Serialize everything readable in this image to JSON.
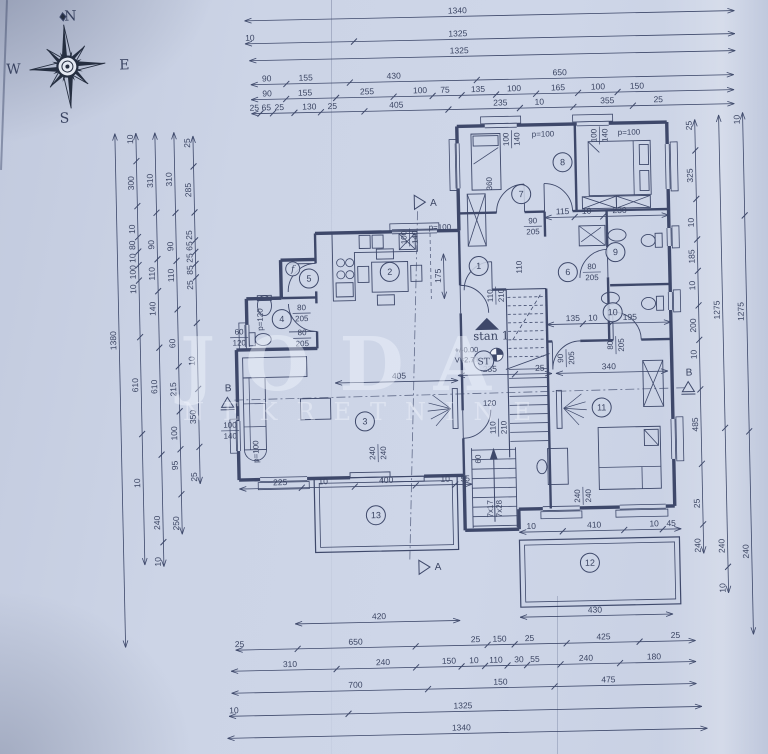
{
  "title": "apartment-floor-plan-scan",
  "colors": {
    "paper": "#ccd4e6",
    "ink": "#323d60",
    "ink_soft": "#46517a",
    "watermark": "rgba(244,248,255,0.42)"
  },
  "compass": {
    "north": "N",
    "east": "E",
    "south": "S",
    "west": "W"
  },
  "watermark": {
    "line1": "JODA",
    "line2": "NEKRETNINE"
  },
  "apartment_label": "stan 1",
  "stair_core_label": "ST",
  "level_marker": {
    "line1": "+/-0.00",
    "line2": "V=2.79"
  },
  "rooms": [
    {
      "n": "1",
      "x": 481,
      "y": 268
    },
    {
      "n": "2",
      "x": 392,
      "y": 272
    },
    {
      "n": "3",
      "x": 364,
      "y": 421
    },
    {
      "n": "4",
      "x": 283,
      "y": 317
    },
    {
      "n": "5",
      "x": 311,
      "y": 277
    },
    {
      "n": "6",
      "x": 570,
      "y": 276
    },
    {
      "n": "7",
      "x": 525,
      "y": 197
    },
    {
      "n": "8",
      "x": 567,
      "y": 166
    },
    {
      "n": "9",
      "x": 618,
      "y": 257
    },
    {
      "n": "10",
      "x": 614,
      "y": 317
    },
    {
      "n": "11",
      "x": 601,
      "y": 412
    },
    {
      "n": "12",
      "x": 586,
      "y": 567
    },
    {
      "n": "13",
      "x": 373,
      "y": 515
    }
  ],
  "small_circles": [
    {
      "n": "f",
      "x": 295,
      "y": 267,
      "italic": true
    }
  ],
  "section_markers": [
    {
      "t": "A",
      "x": 437,
      "y": 207
    },
    {
      "t": "A",
      "x": 434,
      "y": 571
    },
    {
      "t": "B",
      "x": 228,
      "y": 388
    },
    {
      "t": "B",
      "x": 689,
      "y": 382
    }
  ],
  "plan_labels": [
    {
      "t": "100/140",
      "x": 516,
      "y": 142,
      "rot": 90,
      "fr": true
    },
    {
      "t": "p=100",
      "x": 548,
      "y": 140
    },
    {
      "t": "100/140",
      "x": 604,
      "y": 140,
      "rot": 90,
      "fr": true
    },
    {
      "t": "p=100",
      "x": 634,
      "y": 140
    },
    {
      "t": "360",
      "x": 496,
      "y": 186,
      "rot": 90
    },
    {
      "t": "90/205",
      "x": 536,
      "y": 229,
      "fr": true
    },
    {
      "t": "80/205",
      "x": 594,
      "y": 276,
      "fr": true
    },
    {
      "t": "80/205",
      "x": 616,
      "y": 350,
      "rot": 90,
      "fr": true
    },
    {
      "t": "90/205",
      "x": 566,
      "y": 362,
      "rot": 90,
      "fr": true
    },
    {
      "t": "110/210",
      "x": 497,
      "y": 298,
      "rot": 90,
      "fr": true
    },
    {
      "t": "110/210",
      "x": 497,
      "y": 430,
      "rot": 90,
      "fr": true
    },
    {
      "t": "80/205",
      "x": 303,
      "y": 311,
      "fr": true
    },
    {
      "t": "80/205",
      "x": 303,
      "y": 336,
      "fr": true
    },
    {
      "t": "60/120",
      "x": 240,
      "y": 334,
      "fr": true
    },
    {
      "t": "p=120",
      "x": 264,
      "y": 317,
      "rot": 90
    },
    {
      "t": "100/140",
      "x": 412,
      "y": 238,
      "rot": 90,
      "fr": true
    },
    {
      "t": "p=100",
      "x": 443,
      "y": 231
    },
    {
      "t": "100/140",
      "x": 229,
      "y": 427,
      "fr": true
    },
    {
      "t": "p=100",
      "x": 257,
      "y": 449,
      "rot": 90
    },
    {
      "t": "240/240",
      "x": 376,
      "y": 453,
      "rot": 90,
      "fr": true
    },
    {
      "t": "240/240",
      "x": 580,
      "y": 500,
      "rot": 90,
      "fr": true
    },
    {
      "t": "120",
      "x": 489,
      "y": 408
    },
    {
      "t": "110",
      "x": 524,
      "y": 270,
      "rot": 90
    },
    {
      "t": "60",
      "x": 479,
      "y": 461,
      "rot": 90
    },
    {
      "t": "7x17",
      "x": 490,
      "y": 511,
      "rot": 90
    },
    {
      "t": "7x28",
      "x": 499,
      "y": 511,
      "rot": 90
    }
  ],
  "dim_chains": [
    {
      "o": "h",
      "y": 18,
      "x1": 252,
      "x2": 742,
      "labels": [
        [
          "1340",
          465
        ]
      ]
    },
    {
      "o": "h",
      "y": 41,
      "x1": 252,
      "x2": 742,
      "labels": [
        [
          "10",
          257
        ],
        [
          "1325",
          465
        ]
      ]
    },
    {
      "o": "h",
      "y": 58,
      "x1": 256,
      "x2": 742,
      "labels": [
        [
          "1325",
          466
        ]
      ]
    },
    {
      "o": "h",
      "y": 82,
      "x1": 257,
      "x2": 740,
      "labels": [
        [
          "90",
          273
        ],
        [
          "155",
          312
        ],
        [
          "430",
          400
        ],
        [
          "650",
          566
        ]
      ]
    },
    {
      "o": "h",
      "y": 97,
      "x1": 257,
      "x2": 740,
      "labels": [
        [
          "90",
          273
        ],
        [
          "155",
          311
        ],
        [
          "255",
          373
        ],
        [
          "100",
          426
        ],
        [
          "75",
          451
        ],
        [
          "135",
          484
        ],
        [
          "100",
          520
        ],
        [
          "165",
          564
        ],
        [
          "100",
          604
        ],
        [
          "150",
          643
        ]
      ]
    },
    {
      "o": "h",
      "y": 111,
      "x1": 257,
      "x2": 740,
      "labels": [
        [
          "25",
          260
        ],
        [
          "65",
          272
        ],
        [
          "25",
          285
        ],
        [
          "130",
          315
        ],
        [
          "25",
          338
        ],
        [
          "405",
          402
        ],
        [
          "235",
          506
        ],
        [
          "10",
          545
        ],
        [
          "355",
          613
        ],
        [
          "25",
          664
        ]
      ]
    },
    {
      "o": "h",
      "y": 622,
      "x1": 290,
      "x2": 455,
      "labels": [
        [
          "420",
          374
        ]
      ]
    },
    {
      "o": "h",
      "y": 620,
      "x1": 515,
      "x2": 668,
      "labels": [
        [
          "430",
          590
        ]
      ]
    },
    {
      "o": "h",
      "y": 647,
      "x1": 230,
      "x2": 690,
      "labels": [
        [
          "25",
          234
        ],
        [
          "650",
          350
        ],
        [
          "25",
          470
        ],
        [
          "150",
          494
        ],
        [
          "25",
          524
        ],
        [
          "425",
          598
        ],
        [
          "25",
          670
        ]
      ]
    },
    {
      "o": "h",
      "y": 668,
      "x1": 225,
      "x2": 690,
      "labels": [
        [
          "310",
          284
        ],
        [
          "240",
          377
        ],
        [
          "150",
          443
        ],
        [
          "10",
          468
        ],
        [
          "110",
          490
        ],
        [
          "30",
          513
        ],
        [
          "55",
          529
        ],
        [
          "240",
          580
        ],
        [
          "180",
          648
        ]
      ]
    },
    {
      "o": "h",
      "y": 690,
      "x1": 225,
      "x2": 690,
      "labels": [
        [
          "700",
          349
        ],
        [
          "150",
          494
        ],
        [
          "475",
          602
        ]
      ]
    },
    {
      "o": "h",
      "y": 713,
      "x1": 222,
      "x2": 695,
      "labels": [
        [
          "10",
          227
        ],
        [
          "1325",
          456
        ]
      ]
    },
    {
      "o": "h",
      "y": 735,
      "x1": 220,
      "x2": 700,
      "labels": [
        [
          "1340",
          454
        ]
      ]
    },
    {
      "o": "v",
      "x": 120,
      "y1": 128,
      "y2": 642,
      "labels": [
        [
          "1380",
          335
        ]
      ]
    },
    {
      "o": "v",
      "x": 141,
      "y1": 128,
      "y2": 560,
      "labels": [
        [
          "10",
          134
        ],
        [
          "300",
          178
        ],
        [
          "10",
          224
        ],
        [
          "80",
          240
        ],
        [
          "10",
          253
        ],
        [
          "100",
          267
        ],
        [
          "10",
          284
        ],
        [
          "610",
          380
        ],
        [
          "10",
          478
        ]
      ]
    },
    {
      "o": "v",
      "x": 160,
      "y1": 128,
      "y2": 562,
      "labels": [
        [
          "310",
          176
        ],
        [
          "90",
          240
        ],
        [
          "110",
          269
        ],
        [
          "140",
          304
        ],
        [
          "610",
          382
        ],
        [
          "240",
          518
        ],
        [
          "10",
          557
        ]
      ]
    },
    {
      "o": "v",
      "x": 179,
      "y1": 128,
      "y2": 530,
      "labels": [
        [
          "310",
          175
        ],
        [
          "90",
          242
        ],
        [
          "110",
          271
        ],
        [
          "60",
          339
        ],
        [
          "215",
          385
        ],
        [
          "100",
          429
        ],
        [
          "95",
          461
        ],
        [
          "250",
          519
        ]
      ]
    },
    {
      "o": "v",
      "x": 198,
      "y1": 132,
      "y2": 480,
      "labels": [
        [
          "25",
          139
        ],
        [
          "285",
          186
        ],
        [
          "25",
          231
        ],
        [
          "65",
          242
        ],
        [
          "25",
          254
        ],
        [
          "85",
          266
        ],
        [
          "25",
          281
        ],
        [
          "10",
          357
        ],
        [
          "350",
          413
        ],
        [
          "25",
          473
        ]
      ]
    },
    {
      "o": "v",
      "x": 700,
      "y1": 126,
      "y2": 560,
      "labels": [
        [
          "25",
          132
        ],
        [
          "325",
          182
        ],
        [
          "10",
          229
        ],
        [
          "185",
          263
        ],
        [
          "10",
          292
        ],
        [
          "200",
          332
        ],
        [
          "10",
          361
        ],
        [
          "485",
          431
        ],
        [
          "25",
          510
        ],
        [
          "240",
          552
        ]
      ]
    },
    {
      "o": "v",
      "x": 724,
      "y1": 122,
      "y2": 600,
      "labels": [
        [
          "1275",
          317
        ],
        [
          "240",
          553
        ],
        [
          "10",
          595
        ]
      ]
    },
    {
      "o": "v",
      "x": 748,
      "y1": 120,
      "y2": 642,
      "labels": [
        [
          "10",
          127
        ],
        [
          "1275",
          319
        ],
        [
          "240",
          559
        ]
      ]
    },
    {
      "o": "h",
      "y": 221,
      "x1": 548,
      "x2": 672,
      "labels": [
        [
          "115",
          566
        ],
        [
          "10",
          590
        ],
        [
          "230",
          623
        ]
      ]
    },
    {
      "o": "h",
      "y": 328,
      "x1": 548,
      "x2": 672,
      "labels": [
        [
          "135",
          574
        ],
        [
          "10",
          594
        ],
        [
          "195",
          631
        ]
      ]
    },
    {
      "o": "h",
      "y": 377,
      "x1": 556,
      "x2": 668,
      "labels": [
        [
          "340",
          609
        ]
      ]
    },
    {
      "o": "h",
      "y": 377,
      "x1": 458,
      "x2": 552,
      "labels": [
        [
          "235",
          490
        ],
        [
          "25",
          540
        ]
      ]
    },
    {
      "o": "h",
      "y": 382,
      "x1": 335,
      "x2": 458,
      "labels": [
        [
          "405",
          399
        ]
      ]
    },
    {
      "o": "h",
      "y": 486,
      "x1": 237,
      "x2": 470,
      "labels": [
        [
          "225",
          278
        ],
        [
          "10",
          321
        ],
        [
          "400",
          384
        ],
        [
          "10",
          443
        ],
        [
          "55",
          463
        ]
      ]
    },
    {
      "o": "h",
      "y": 535,
      "x1": 516,
      "x2": 678,
      "labels": [
        [
          "10",
          528
        ],
        [
          "410",
          591
        ],
        [
          "10",
          651
        ],
        [
          "45",
          668
        ]
      ]
    },
    {
      "o": "v",
      "x": 446,
      "y1": 255,
      "y2": 300,
      "labels": [
        [
          "175",
          277
        ]
      ]
    }
  ]
}
